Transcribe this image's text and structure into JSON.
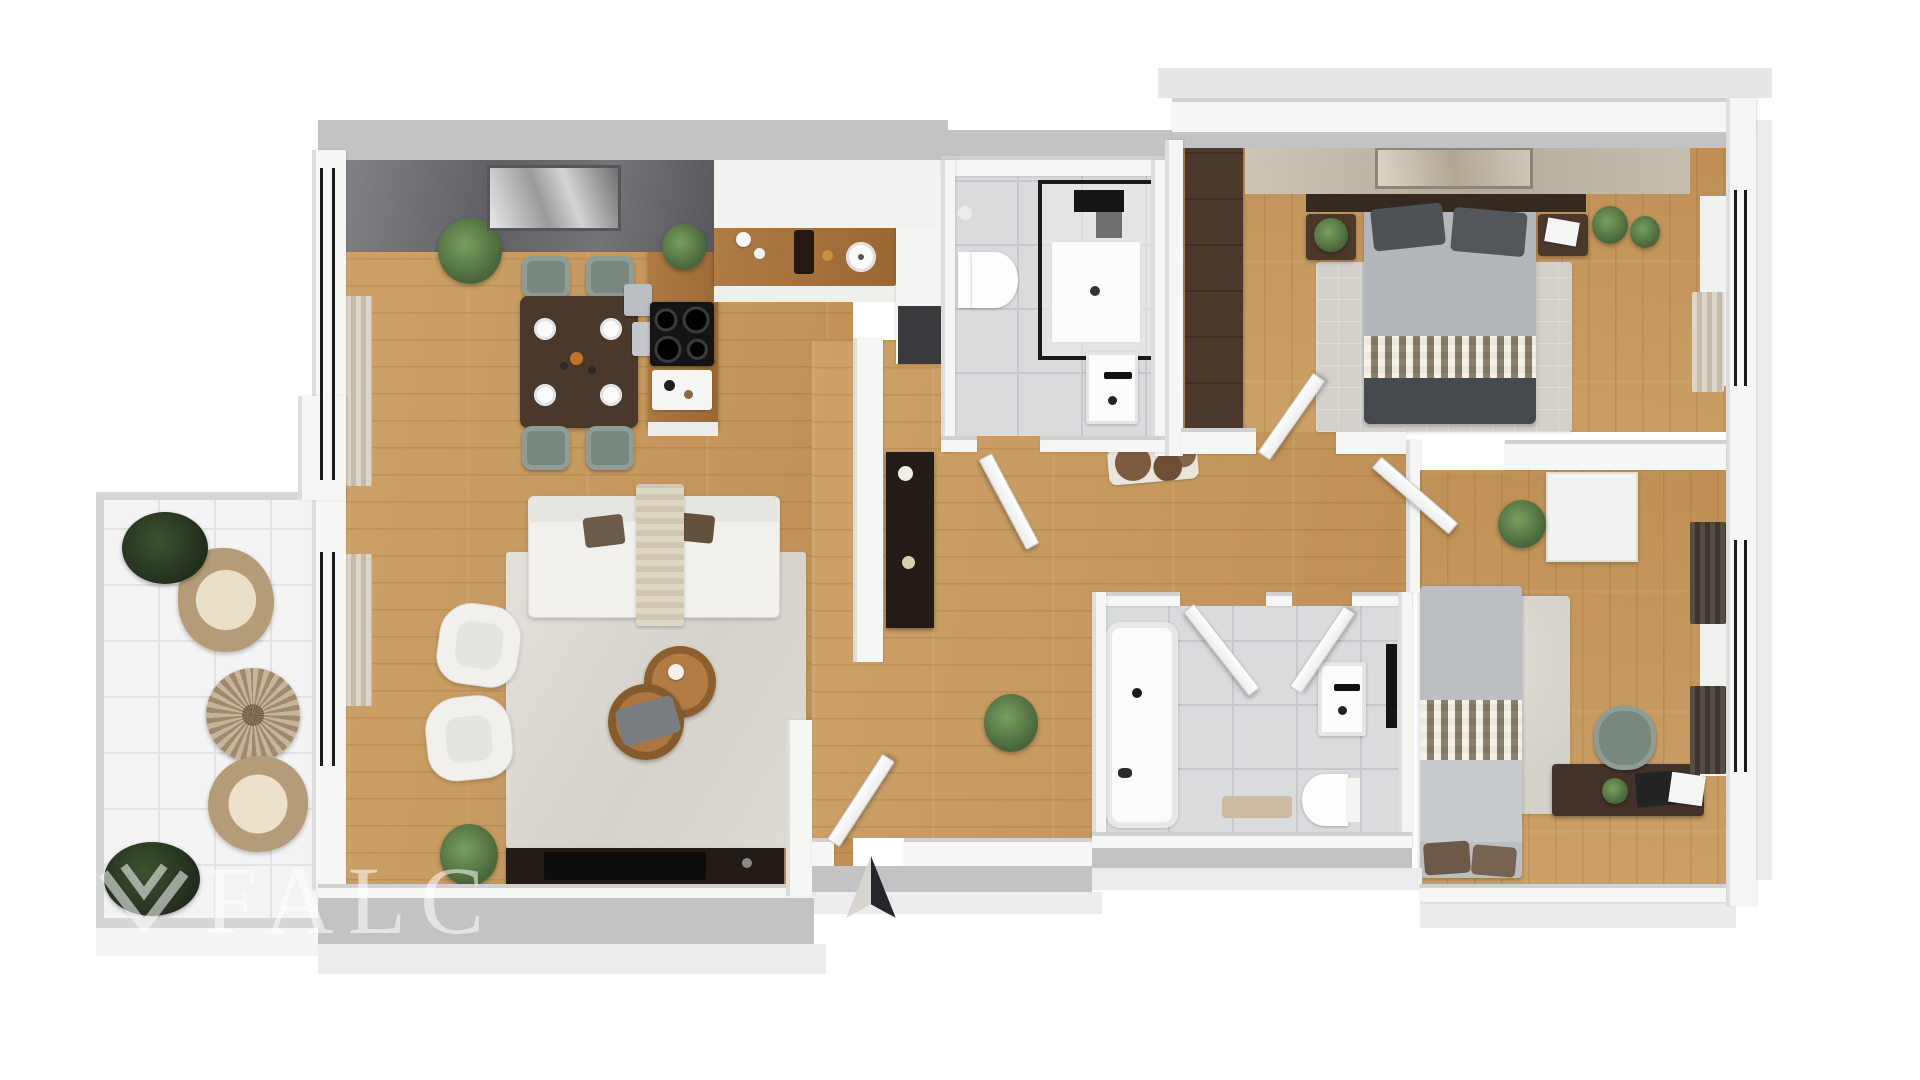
{
  "watermark": {
    "brand": "FALC",
    "logo": "falc-chevron-bird-logo"
  },
  "compass": {
    "direction": "N",
    "icon": "north-arrow-icon"
  },
  "palette": {
    "background": "#ffffff",
    "wood_floor": "#cda269",
    "wood_floor_dark": "#bf8f55",
    "tile_bath": "#dadbdd",
    "tile_balcony": "#f4f4f4",
    "wall_white": "#f6f6f5",
    "wall_shadow": "#c3c3c5",
    "slab": "#ececec",
    "accent_concrete": "#6a6a6e",
    "accent_stone": "#c2bAAa",
    "furniture_dark_wood": "#4a382a",
    "kitchen_wood": "#a4713c",
    "sofa_white": "#f1f0ec",
    "chair_teal": "#78887f",
    "bed_gray": "#53565a",
    "plant_green": "#49663a",
    "rug_light": "#dcdad2",
    "door_white": "#fcfcfc",
    "console_black": "#221b16"
  },
  "rooms": [
    {
      "name": "balcony",
      "floor": "white-tile",
      "items": [
        "potted-plant",
        "wicker-lounge-chair",
        "round-wicker-table",
        "wicker-lounge-chair",
        "potted-plant"
      ]
    },
    {
      "name": "living-dining-room",
      "floor": "oak-plank",
      "items": [
        "concrete-accent-wall",
        "wall-art",
        "window-curtains",
        "dining-table",
        "dining-chairs-x4",
        "place-settings",
        "potted-plant",
        "sofa",
        "throw-blanket",
        "cushions",
        "armchair",
        "armchair",
        "nesting-coffee-tables",
        "area-rug",
        "tv-sideboard",
        "tv",
        "potted-plant"
      ]
    },
    {
      "name": "kitchen",
      "floor": "oak-plank",
      "items": [
        "island-with-cooktop",
        "bar-stools",
        "counter-with-round-sink",
        "tall-unit-with-oven",
        "potted-plant"
      ]
    },
    {
      "name": "bathroom-1",
      "floor": "gray-tile",
      "items": [
        "walk-in-shower",
        "wall-hung-toilet",
        "washbasin"
      ]
    },
    {
      "name": "hallway",
      "floor": "oak-plank",
      "items": [
        "black-console",
        "vases",
        "cowhide-doormat",
        "potted-plant",
        "entrance-door"
      ]
    },
    {
      "name": "bedroom-1",
      "floor": "oak-plank",
      "items": [
        "stone-accent-wall",
        "wall-art",
        "tall-dark-wardrobe",
        "double-bed",
        "nightstand",
        "nightstand",
        "potted-plants",
        "area-rug",
        "window-curtain"
      ]
    },
    {
      "name": "bathroom-2",
      "floor": "gray-tile",
      "items": [
        "bathtub",
        "washbasin",
        "mirror",
        "toilet",
        "bath-mat"
      ]
    },
    {
      "name": "bedroom-2",
      "floor": "oak-plank",
      "items": [
        "single-bed",
        "shag-rug",
        "desk",
        "laptop",
        "office-chair",
        "white-wardrobe",
        "potted-plant",
        "window-curtains"
      ]
    }
  ]
}
